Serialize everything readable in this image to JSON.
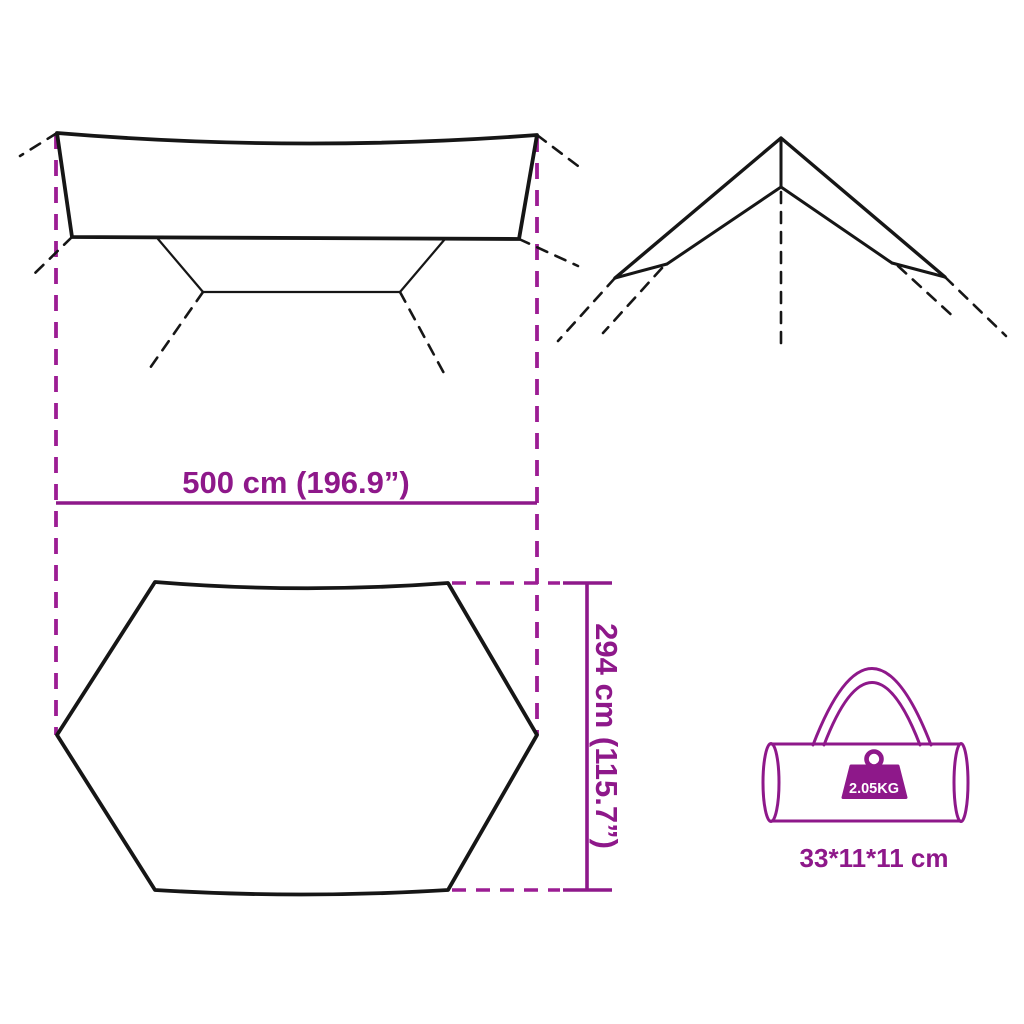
{
  "colors": {
    "background": "#FFFFFF",
    "outline_black": "#161616",
    "dimension_magenta": "#8E188A",
    "guide_dash_magenta": "#9C1D94",
    "weight_badge_fill": "#8E188A",
    "weight_badge_text": "#FFFFFF"
  },
  "dimensions": {
    "width": {
      "label": "500 cm (196.9”)"
    },
    "height": {
      "label": "294 cm (115.7”)"
    },
    "bag": {
      "size_label": "33*11*11 cm",
      "weight_label": "2.05KG"
    }
  },
  "icons": {
    "weight_icon": "kettlebell-weight-icon",
    "bag_icon": "cylindrical-carry-bag-icon"
  }
}
